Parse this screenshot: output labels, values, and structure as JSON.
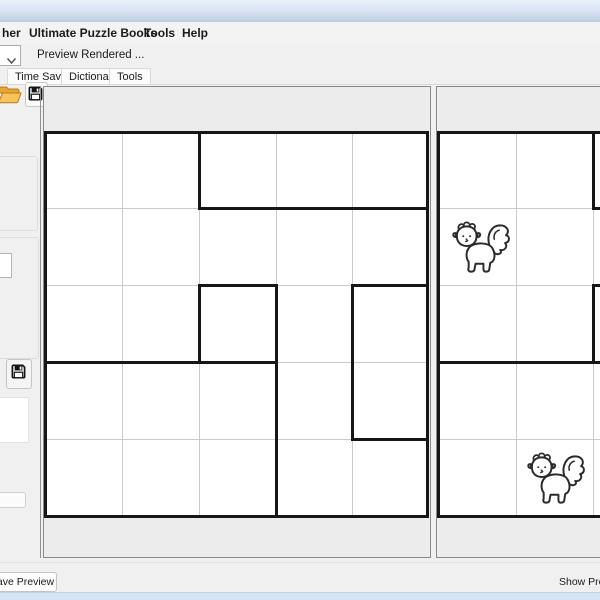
{
  "menu": {
    "items": [
      {
        "label": "her"
      },
      {
        "label": "Ultimate Puzzle Books"
      },
      {
        "label": "Tools"
      },
      {
        "label": "Help"
      }
    ]
  },
  "toolbar": {
    "preview_label": "Preview Rendered ...",
    "combo_value": "",
    "icons": [
      {
        "name": "open-folder-icon"
      },
      {
        "name": "save-icon"
      },
      {
        "name": "sidebar-save-icon"
      },
      {
        "name": "chevron-down-icon"
      }
    ]
  },
  "tabs": {
    "items": [
      {
        "label": "Time Saver"
      },
      {
        "label": "Dictionary"
      },
      {
        "label": "Tools"
      }
    ]
  },
  "buttons": {
    "save_preview_label": "Save Preview",
    "show_preview_label": "Show Preview"
  },
  "colors": {
    "accent_titlebar": "#dbe6f4",
    "status_strip": "#d6e5f5",
    "folder_orange": "#f6c35c",
    "grid_thin": "#cbcbcb",
    "grid_bold": "#161616",
    "panel_border": "#8a8a8a"
  },
  "grids": [
    {
      "container": "left-grid-canvas",
      "bg": {
        "x": 1,
        "y": 45,
        "w": 382,
        "h": 384
      },
      "thin_v": [
        78,
        155,
        232,
        308
      ],
      "thin_h": [
        121,
        198,
        275,
        352
      ],
      "bold": [
        {
          "d": "v",
          "x": 155,
          "y1": 45,
          "y2": 121
        },
        {
          "d": "h",
          "y": 121,
          "x1": 155,
          "x2": 383
        },
        {
          "d": "h",
          "y": 198,
          "x1": 155,
          "x2": 232
        },
        {
          "d": "v",
          "x": 155,
          "y1": 198,
          "y2": 275
        },
        {
          "d": "v",
          "x": 232,
          "y1": 198,
          "y2": 275
        },
        {
          "d": "h",
          "y": 275,
          "x1": 1,
          "x2": 232
        },
        {
          "d": "v",
          "x": 232,
          "y1": 275,
          "y2": 429
        },
        {
          "d": "h",
          "y": 198,
          "x1": 308,
          "x2": 383
        },
        {
          "d": "v",
          "x": 308,
          "y1": 198,
          "y2": 352
        },
        {
          "d": "h",
          "y": 352,
          "x1": 308,
          "x2": 383
        }
      ],
      "outer": {
        "x": 1,
        "y": 45,
        "w": 382,
        "h": 384
      },
      "cats": []
    },
    {
      "container": "right-grid-canvas",
      "bg": {
        "x": 1,
        "y": 45,
        "w": 233,
        "h": 384
      },
      "thin_v": [
        79,
        156
      ],
      "thin_h": [
        121,
        198,
        275,
        352
      ],
      "bold": [
        {
          "d": "v",
          "x": 1,
          "y1": 45,
          "y2": 429
        },
        {
          "d": "h",
          "y": 45,
          "x1": 1,
          "x2": 234
        },
        {
          "d": "h",
          "y": 429,
          "x1": 1,
          "x2": 234
        },
        {
          "d": "v",
          "x": 156,
          "y1": 45,
          "y2": 121
        },
        {
          "d": "h",
          "y": 121,
          "x1": 156,
          "x2": 234
        },
        {
          "d": "v",
          "x": 156,
          "y1": 198,
          "y2": 275
        },
        {
          "d": "h",
          "y": 198,
          "x1": 156,
          "x2": 234
        },
        {
          "d": "h",
          "y": 275,
          "x1": 1,
          "x2": 234
        }
      ],
      "outer": null,
      "cats": [
        {
          "x": 11,
          "y": 128,
          "w": 63,
          "h": 64
        },
        {
          "x": 86,
          "y": 358,
          "w": 63,
          "h": 66
        }
      ]
    }
  ]
}
